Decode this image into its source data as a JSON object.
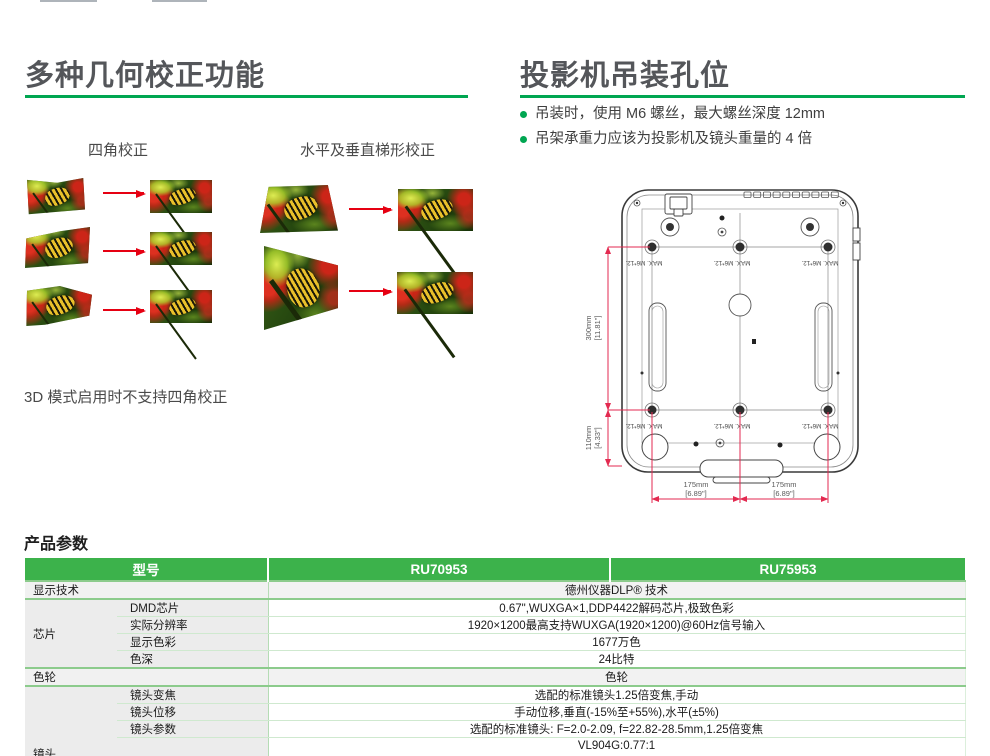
{
  "accent": {
    "green": "#00A651",
    "table_green": "#3CB24B",
    "arrow_red": "#E60012",
    "dim_red": "#E32A50"
  },
  "left_section": {
    "title": "多种几何校正功能",
    "caption_corner": "四角校正",
    "caption_keystone": "水平及垂直梯形校正",
    "note": "3D 模式启用时不支持四角校正"
  },
  "right_section": {
    "title": "投影机吊装孔位",
    "bullets": [
      "吊装时，使用 M6 螺丝，最大螺丝深度 12mm",
      "吊架承重力应该为投影机及镜头重量的 4 倍"
    ],
    "diagram": {
      "screw_label": "MAX. M6*12.",
      "dim_vertical_1": "300mm",
      "dim_vertical_1_in": "[11.81\"]",
      "dim_vertical_2": "110mm",
      "dim_vertical_2_in": "[4.33\"]",
      "dim_horizontal_1": "175mm",
      "dim_horizontal_1_in": "[6.89\"]",
      "dim_horizontal_2": "175mm",
      "dim_horizontal_2_in": "[6.89\"]"
    }
  },
  "table": {
    "title": "产品参数",
    "header": {
      "model": "型号",
      "col1": "RU70953",
      "col2": "RU75953"
    },
    "rows": {
      "display_tech": {
        "label": "显示技术",
        "value": "德州仪器DLP® 技术"
      },
      "chip": {
        "label": "芯片",
        "subs": [
          {
            "label": "DMD芯片",
            "value": "0.67\",WUXGA×1,DDP4422解码芯片,极致色彩"
          },
          {
            "label": "实际分辨率",
            "value": "1920×1200最高支持WUXGA(1920×1200)@60Hz信号输入"
          },
          {
            "label": "显示色彩",
            "value": "1677万色"
          },
          {
            "label": "色深",
            "value": "24比特"
          }
        ]
      },
      "color_wheel": {
        "label": "色轮",
        "value": "色轮"
      },
      "lens": {
        "label": "镜头",
        "subs": [
          {
            "label": "镜头变焦",
            "value": "选配的标准镜头1.25倍变焦,手动"
          },
          {
            "label": "镜头位移",
            "value": "手动位移,垂直(-15%至+55%),水平(±5%)"
          },
          {
            "label": "镜头参数",
            "value": "选配的标准镜头: F=2.0-2.09, f=22.82-28.5mm,1.25倍变焦"
          },
          {
            "label": "",
            "value": "VL904G:0.77:1"
          },
          {
            "label": "",
            "value": "VL907G:1.1-1.3"
          }
        ]
      }
    }
  }
}
